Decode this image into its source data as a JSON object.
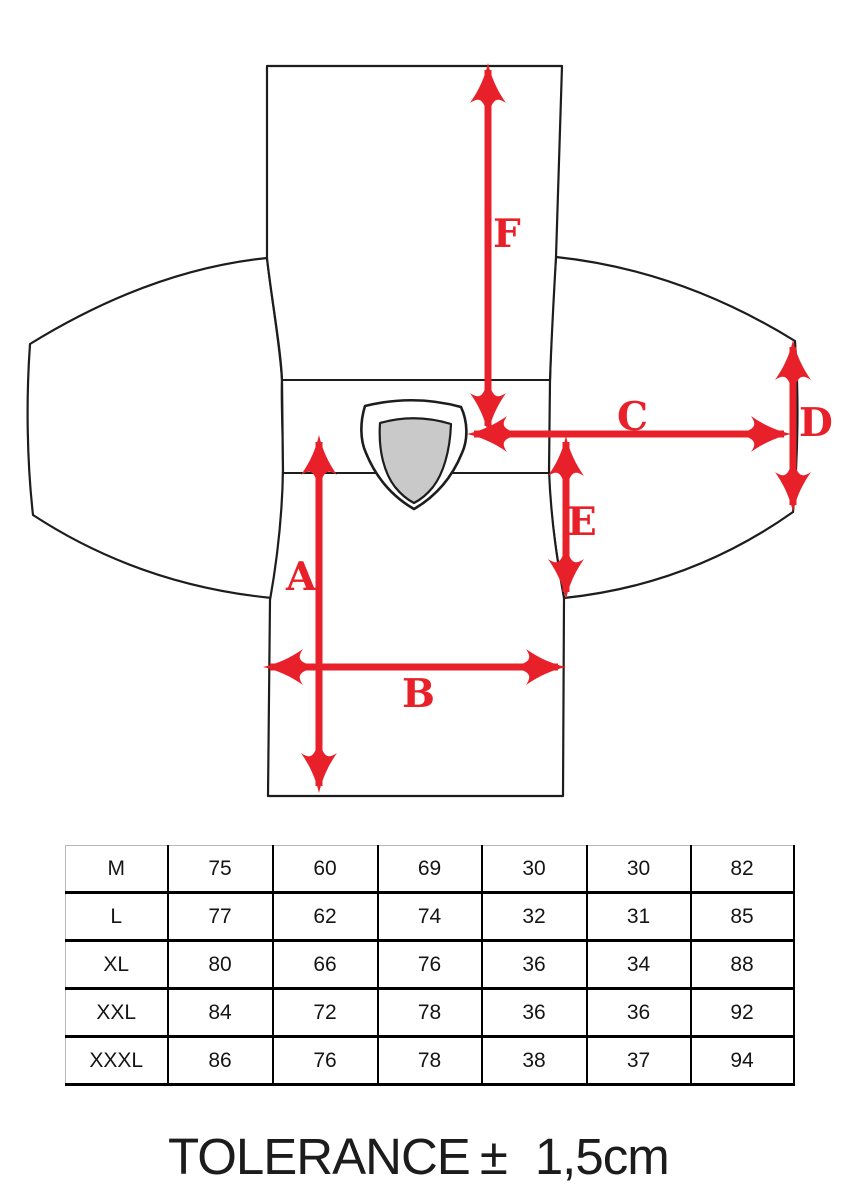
{
  "diagram": {
    "title": "garment flat sketch with measurement arrows",
    "labels": {
      "a": "A",
      "b": "B",
      "c": "C",
      "d": "D",
      "e": "E",
      "f": "F"
    },
    "arrow_color": "#e8202a",
    "outline_color": "#1d1d1d",
    "collar_fill": "#c9c9c9"
  },
  "size_table": {
    "rows": [
      {
        "size": "M",
        "values": [
          "75",
          "60",
          "69",
          "30",
          "30",
          "82"
        ]
      },
      {
        "size": "L",
        "values": [
          "77",
          "62",
          "74",
          "32",
          "31",
          "85"
        ]
      },
      {
        "size": "XL",
        "values": [
          "80",
          "66",
          "76",
          "36",
          "34",
          "88"
        ]
      },
      {
        "size": "XXL",
        "values": [
          "84",
          "72",
          "78",
          "36",
          "36",
          "92"
        ]
      },
      {
        "size": "XXXL",
        "values": [
          "86",
          "76",
          "78",
          "38",
          "37",
          "94"
        ]
      }
    ]
  },
  "tolerance": {
    "label": "TOLERANCE",
    "sign": "±",
    "value": "1,5cm"
  }
}
